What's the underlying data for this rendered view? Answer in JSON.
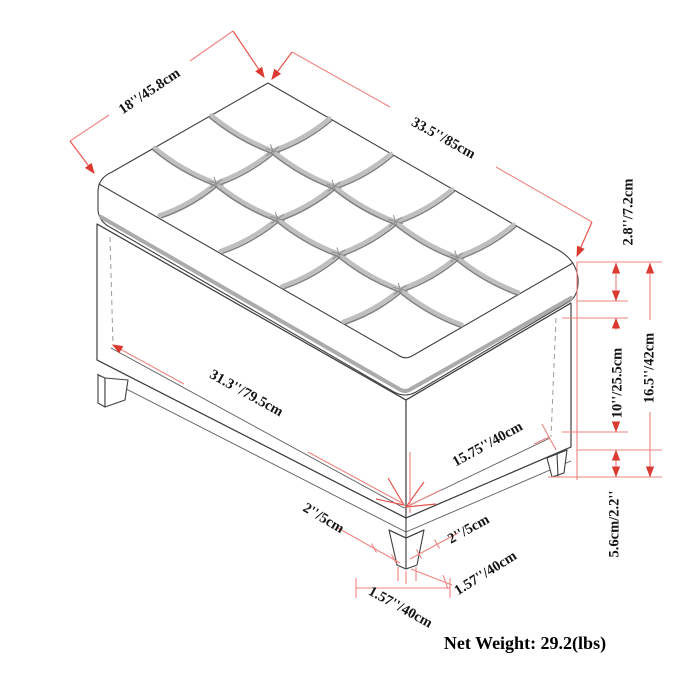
{
  "diagram": {
    "title": "storage-ottoman-dimension-diagram",
    "labels": {
      "top_depth": "18''/45.8cm",
      "top_width": "33.5''/85cm",
      "lid_thickness": "2.8''/7.2cm",
      "interior_height": "10''/25.5cm",
      "total_height": "16.5''/42cm",
      "leg_height": "5.6cm/2.2''",
      "interior_width": "31.3''/79.5cm",
      "interior_depth": "15.75''/40cm",
      "leg_width_left": "2''/5cm",
      "leg_width_right": "2''/5cm",
      "leg_foot_right": "1.57''/40cm",
      "leg_foot_front": "1.57''/40cm",
      "net_weight": "Net Weight: 29.2(lbs)"
    },
    "colors": {
      "background": "#ffffff",
      "drawing_outline": "#3f3f3f",
      "tufting_gray": "#bfbfbf",
      "dimension_line": "#f0827f",
      "dimension_arrow": "#da3a30",
      "label_text": "#141414"
    }
  }
}
